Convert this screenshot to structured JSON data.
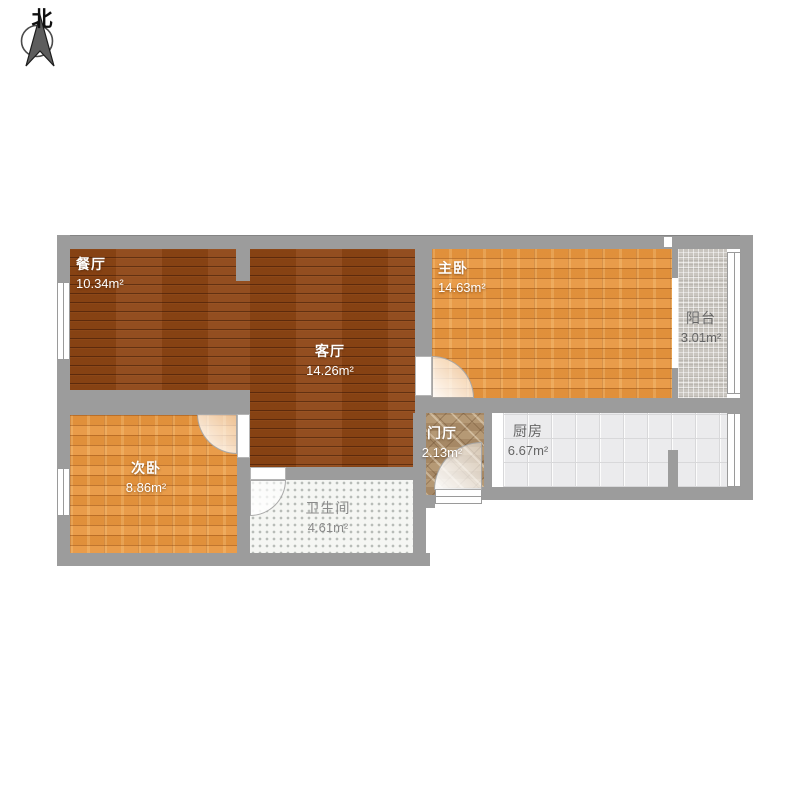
{
  "compass": {
    "label": "北"
  },
  "plan": {
    "rooms": [
      {
        "id": "dining",
        "name": "餐厅",
        "area": "10.34m²"
      },
      {
        "id": "living",
        "name": "客厅",
        "area": "14.26m²"
      },
      {
        "id": "master-bedroom",
        "name": "主卧",
        "area": "14.63m²"
      },
      {
        "id": "balcony",
        "name": "阳台",
        "area": "3.01m²"
      },
      {
        "id": "second-bedroom",
        "name": "次卧",
        "area": "8.86m²"
      },
      {
        "id": "bathroom",
        "name": "卫生间",
        "area": "4.61m²"
      },
      {
        "id": "entry-hall",
        "name": "门厅",
        "area": "2.13m²"
      },
      {
        "id": "kitchen",
        "name": "厨房",
        "area": "6.67m²"
      }
    ],
    "colors": {
      "wall": "#9c9c9c",
      "wood_dark": "#8d4514",
      "wood_orange": "#e6953f",
      "balcony_tile": "#c9c5bf",
      "bath_tile": "#f5f6f3",
      "kitchen_tile": "#ebebed",
      "hall_tile": "#ab8e6a",
      "label_light": "#ffffff",
      "label_dark": "#666666"
    }
  }
}
